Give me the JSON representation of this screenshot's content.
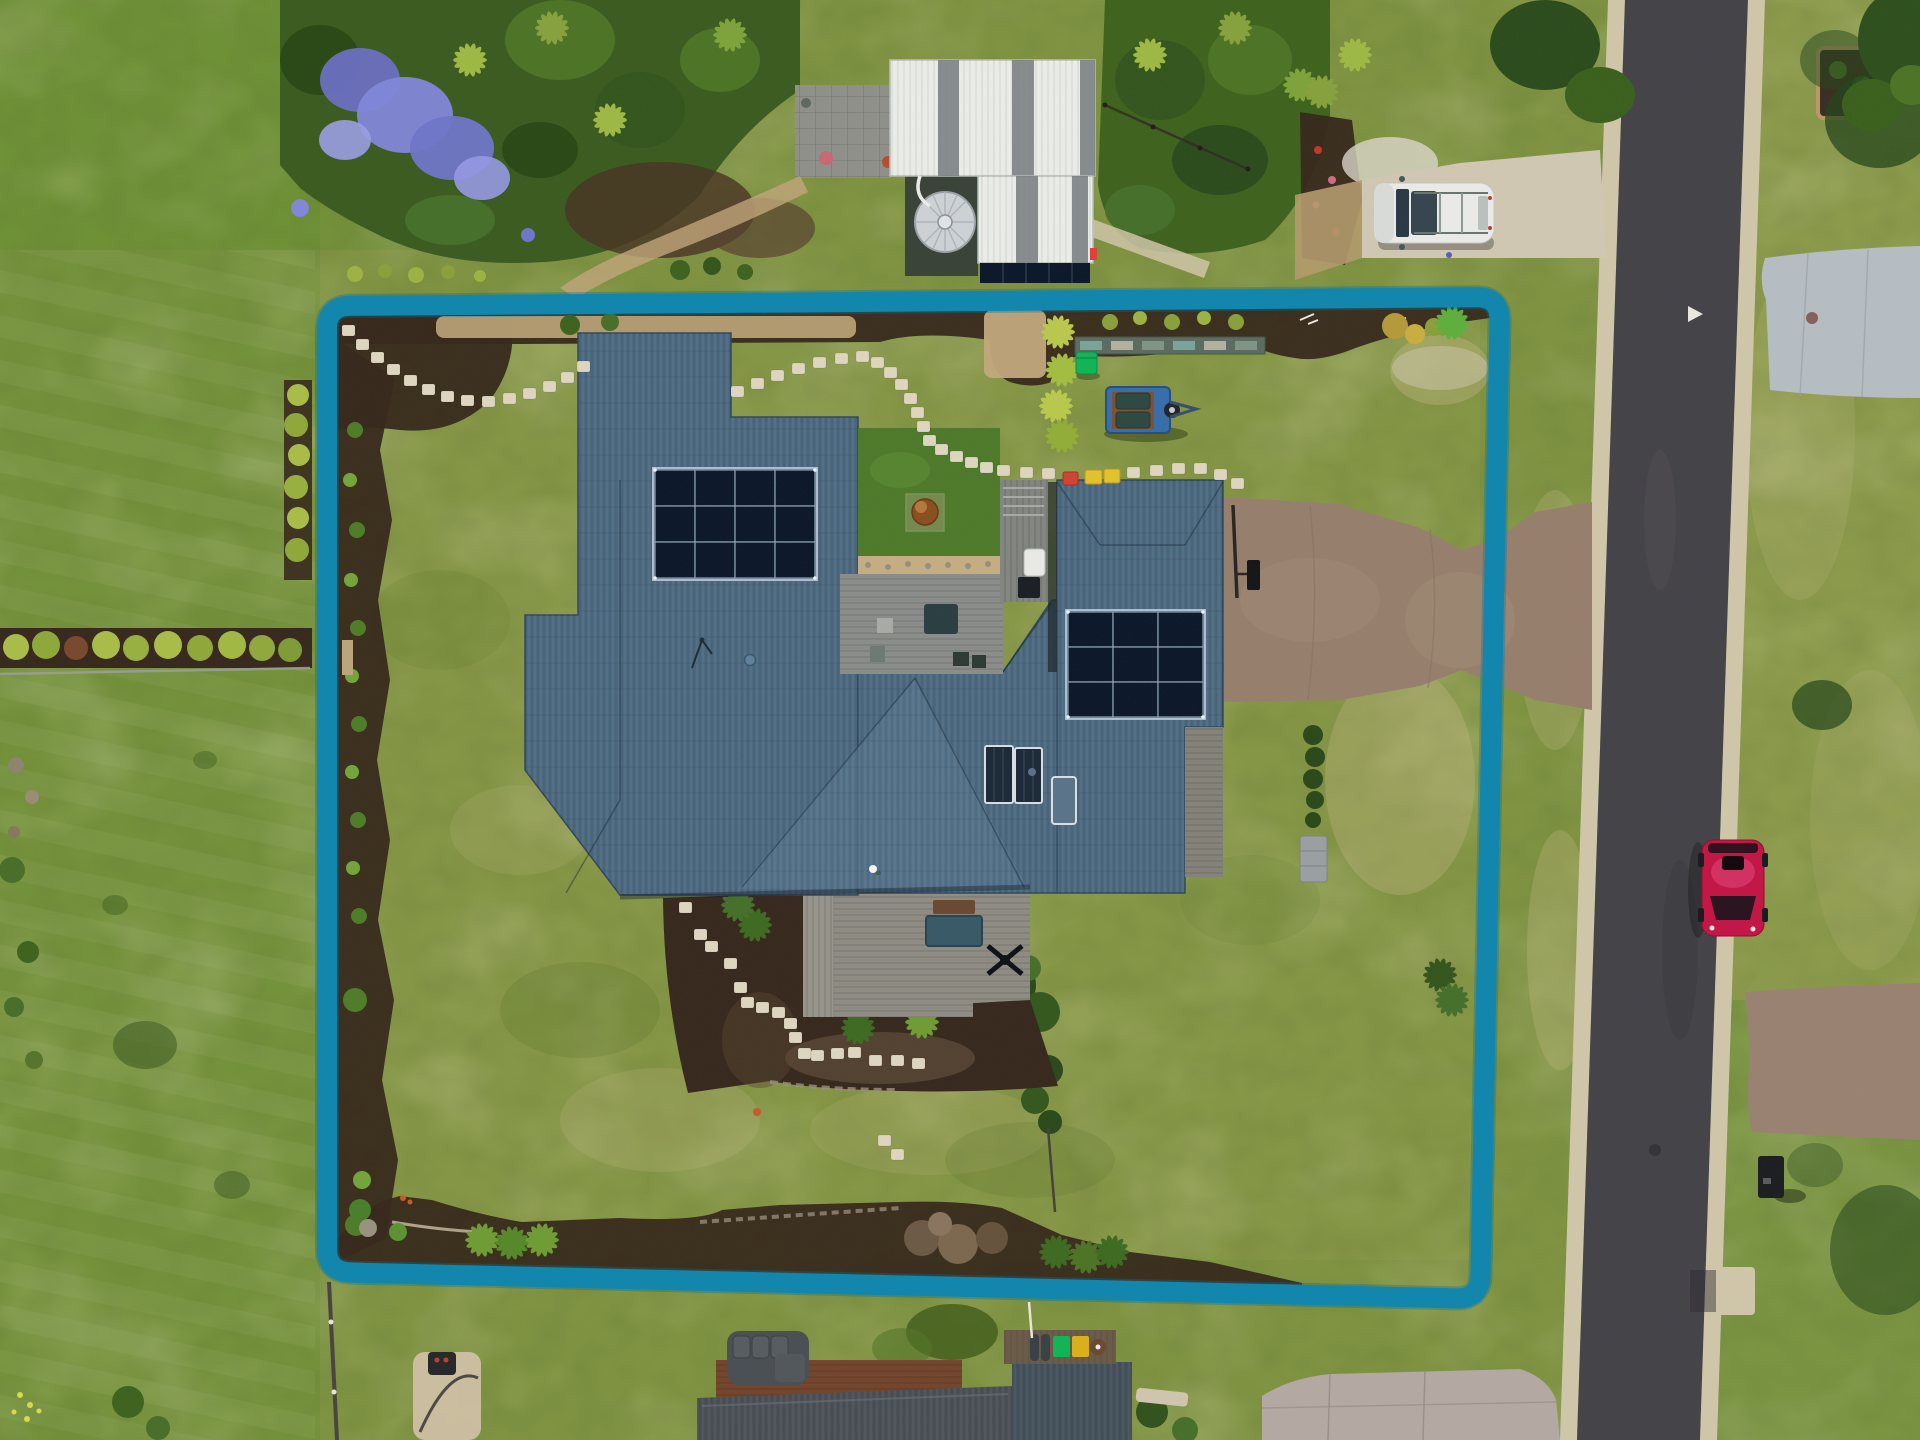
{
  "scene": {
    "type": "aerial-drone-photograph",
    "subject": "Residential property for sale with highlighted lot boundary",
    "overlay": {
      "name": "lot-boundary",
      "shape": "rounded rectangle, slightly rotated",
      "stroke_width_px": 20
    },
    "property": {
      "house": {
        "roof": "complex hip roof, steel blue-grey corrugated",
        "solar_array_main": {
          "panels": 12,
          "layout": "4x3"
        },
        "solar_array_garage": {
          "panels": 9,
          "layout": "3x3"
        },
        "solar_hot_water_collectors": 2,
        "skylight": 1,
        "courtyard": [
          "lawn",
          "rusted fire bowl",
          "timber deck with furniture"
        ],
        "rear_deck": [
          "timber bench",
          "dark spa box",
          "ceiling-fan object"
        ]
      },
      "shed": {
        "roof": "white corrugated with 5 translucent strips",
        "pv_strip": true,
        "water_tank": 1
      },
      "vehicles": {
        "white_suv": "parked on front driveway",
        "red_hatchback": "parked on road",
        "box_trailer": "on lawn"
      },
      "bins_and_crates": {
        "green_wheelie_bin": 1,
        "red_crate": 1,
        "yellow_crates": 2
      },
      "stepping_stones_total": 50,
      "basketball_hoop": 1,
      "mailbox": 1,
      "jacaranda_tree": "purple flowering, top left",
      "road": "asphalt, runs vertically on right with concrete kerbs"
    },
    "colors": {
      "boundary": "#1286ac",
      "grassBase": "#7f9342",
      "grassOut": "#6a8f33",
      "lawnCourt": "#4f7a2c",
      "road": "#454449",
      "curb": "#cfc6aa",
      "apron": "#b5bcc2",
      "driveHouse": "#96806d",
      "driveWhite": "#cfc7b2",
      "crossover": "#9a8273",
      "pad": "#b3a9a2",
      "roof": "#4d6a81",
      "roofLight": "#5a7890",
      "shed": "#e9ebe7",
      "solar": "#0e1a2c",
      "tank": "#ccd1d4",
      "deck": "#8f8c84",
      "mulch": "#382a1e",
      "pebble": "#c4ad83",
      "stone": "#ddd5bf",
      "suv": "#e9eae7",
      "carRed": "#c21747",
      "trailerBlue": "#3a6ea8",
      "binGreen": "#12b457",
      "crateRed": "#cf4434",
      "crateYellow": "#e2c12f",
      "jacaranda": "#8287d8",
      "folDark": "#2e4d1e",
      "folMid": "#4e7427",
      "folLight": "#9db845",
      "hedge": "#a9bc4a",
      "nbrRoof": "#4b5157",
      "rustDeck": "#74462e"
    }
  }
}
